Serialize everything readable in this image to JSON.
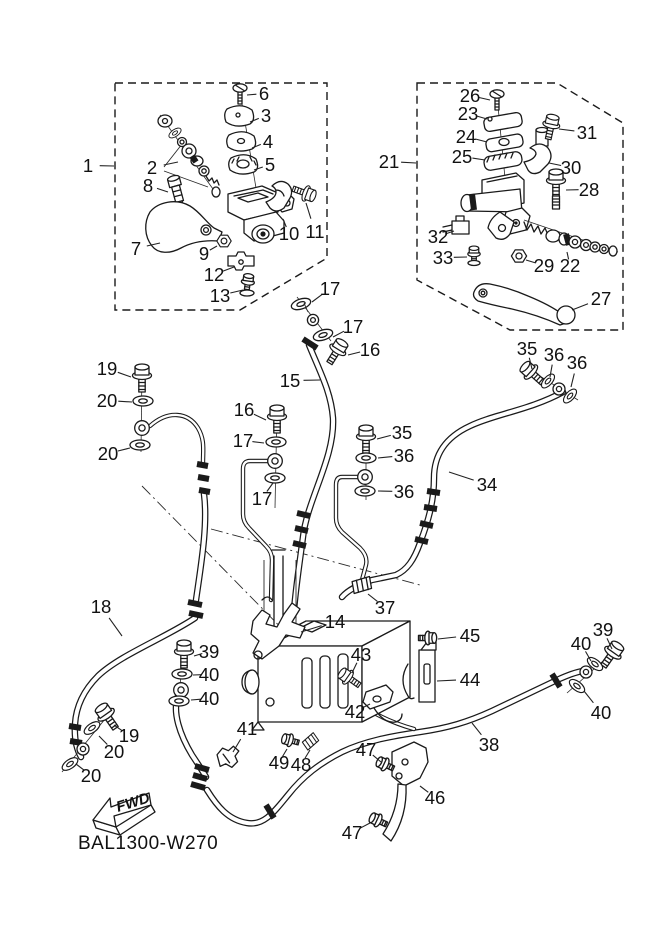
{
  "diagram": {
    "code": "BAL1300-W270",
    "fwd_label": "FWD"
  },
  "colors": {
    "line": "#1a1a1a",
    "background": "#ffffff"
  },
  "callouts": [
    {
      "n": "1",
      "x": 88,
      "y": 172,
      "lx": 114,
      "ly": 166
    },
    {
      "n": "2",
      "x": 152,
      "y": 174,
      "lx": 178,
      "ly": 162
    },
    {
      "n": "6",
      "x": 264,
      "y": 100,
      "lx": 247,
      "ly": 95
    },
    {
      "n": "3",
      "x": 266,
      "y": 122,
      "lx": 250,
      "ly": 122
    },
    {
      "n": "4",
      "x": 268,
      "y": 148,
      "lx": 252,
      "ly": 148
    },
    {
      "n": "5",
      "x": 270,
      "y": 171,
      "lx": 254,
      "ly": 170
    },
    {
      "n": "8",
      "x": 148,
      "y": 192,
      "lx": 168,
      "ly": 192
    },
    {
      "n": "7",
      "x": 136,
      "y": 255,
      "lx": 160,
      "ly": 243
    },
    {
      "n": "9",
      "x": 204,
      "y": 260,
      "lx": 217,
      "ly": 246
    },
    {
      "n": "10",
      "x": 289,
      "y": 240,
      "lx": 283,
      "ly": 219
    },
    {
      "n": "11",
      "x": 315,
      "y": 238,
      "lx": 306,
      "ly": 203
    },
    {
      "n": "12",
      "x": 214,
      "y": 281,
      "lx": 234,
      "ly": 267
    },
    {
      "n": "13",
      "x": 220,
      "y": 302,
      "lx": 243,
      "ly": 290
    },
    {
      "n": "17",
      "x": 330,
      "y": 295,
      "lx": 312,
      "ly": 302
    },
    {
      "n": "21",
      "x": 389,
      "y": 168,
      "lx": 416,
      "ly": 163
    },
    {
      "n": "26",
      "x": 470,
      "y": 102,
      "lx": 490,
      "ly": 100
    },
    {
      "n": "23",
      "x": 468,
      "y": 120,
      "lx": 487,
      "ly": 119
    },
    {
      "n": "24",
      "x": 466,
      "y": 143,
      "lx": 487,
      "ly": 142
    },
    {
      "n": "25",
      "x": 462,
      "y": 163,
      "lx": 485,
      "ly": 160
    },
    {
      "n": "31",
      "x": 587,
      "y": 139,
      "lx": 559,
      "ly": 129
    },
    {
      "n": "30",
      "x": 571,
      "y": 174,
      "lx": 549,
      "ly": 163
    },
    {
      "n": "28",
      "x": 589,
      "y": 196,
      "lx": 566,
      "ly": 190
    },
    {
      "n": "32",
      "x": 438,
      "y": 243,
      "lx": 454,
      "ly": 231
    },
    {
      "n": "33",
      "x": 443,
      "y": 264,
      "lx": 467,
      "ly": 257
    },
    {
      "n": "29",
      "x": 544,
      "y": 272,
      "lx": 526,
      "ly": 260
    },
    {
      "n": "22",
      "x": 570,
      "y": 272,
      "lx": 567,
      "ly": 252
    },
    {
      "n": "27",
      "x": 601,
      "y": 305,
      "lx": 572,
      "ly": 310
    },
    {
      "n": "17",
      "x": 353,
      "y": 333,
      "lx": 333,
      "ly": 337
    },
    {
      "n": "16",
      "x": 370,
      "y": 356,
      "lx": 348,
      "ly": 355
    },
    {
      "n": "15",
      "x": 290,
      "y": 387,
      "lx": 320,
      "ly": 380
    },
    {
      "n": "16",
      "x": 244,
      "y": 416,
      "lx": 266,
      "ly": 420
    },
    {
      "n": "17",
      "x": 243,
      "y": 447,
      "lx": 264,
      "ly": 443
    },
    {
      "n": "17",
      "x": 262,
      "y": 505,
      "lx": 273,
      "ly": 483
    },
    {
      "n": "35",
      "x": 402,
      "y": 439,
      "lx": 377,
      "ly": 439
    },
    {
      "n": "36",
      "x": 404,
      "y": 462,
      "lx": 378,
      "ly": 458
    },
    {
      "n": "36",
      "x": 404,
      "y": 498,
      "lx": 378,
      "ly": 491
    },
    {
      "n": "35",
      "x": 527,
      "y": 355,
      "lx": 532,
      "ly": 369
    },
    {
      "n": "36",
      "x": 554,
      "y": 361,
      "lx": 550,
      "ly": 377
    },
    {
      "n": "36",
      "x": 577,
      "y": 369,
      "lx": 571,
      "ly": 387
    },
    {
      "n": "34",
      "x": 487,
      "y": 491,
      "lx": 449,
      "ly": 472
    },
    {
      "n": "19",
      "x": 107,
      "y": 375,
      "lx": 131,
      "ly": 377
    },
    {
      "n": "20",
      "x": 107,
      "y": 407,
      "lx": 132,
      "ly": 402
    },
    {
      "n": "20",
      "x": 108,
      "y": 460,
      "lx": 130,
      "ly": 448
    },
    {
      "n": "18",
      "x": 101,
      "y": 613,
      "lx": 122,
      "ly": 636
    },
    {
      "n": "39",
      "x": 209,
      "y": 658,
      "lx": 194,
      "ly": 656
    },
    {
      "n": "40",
      "x": 209,
      "y": 681,
      "lx": 193,
      "ly": 675
    },
    {
      "n": "40",
      "x": 209,
      "y": 705,
      "lx": 191,
      "ly": 700
    },
    {
      "n": "19",
      "x": 129,
      "y": 742,
      "lx": 114,
      "ly": 725
    },
    {
      "n": "20",
      "x": 114,
      "y": 758,
      "lx": 99,
      "ly": 736
    },
    {
      "n": "20",
      "x": 91,
      "y": 782,
      "lx": 76,
      "ly": 764
    },
    {
      "n": "37",
      "x": 385,
      "y": 614,
      "lx": 368,
      "ly": 594
    },
    {
      "n": "14",
      "x": 335,
      "y": 628,
      "lx": 301,
      "ly": 632
    },
    {
      "n": "43",
      "x": 361,
      "y": 661,
      "lx": 352,
      "ly": 673
    },
    {
      "n": "42",
      "x": 355,
      "y": 718,
      "lx": 370,
      "ly": 704
    },
    {
      "n": "45",
      "x": 470,
      "y": 642,
      "lx": 438,
      "ly": 639
    },
    {
      "n": "44",
      "x": 470,
      "y": 686,
      "lx": 437,
      "ly": 681
    },
    {
      "n": "41",
      "x": 247,
      "y": 735,
      "lx": 233,
      "ly": 752
    },
    {
      "n": "49",
      "x": 279,
      "y": 769,
      "lx": 287,
      "ly": 749
    },
    {
      "n": "48",
      "x": 301,
      "y": 771,
      "lx": 310,
      "ly": 750
    },
    {
      "n": "47",
      "x": 366,
      "y": 756,
      "lx": 381,
      "ly": 762
    },
    {
      "n": "46",
      "x": 435,
      "y": 804,
      "lx": 420,
      "ly": 786
    },
    {
      "n": "47",
      "x": 352,
      "y": 839,
      "lx": 370,
      "ly": 823
    },
    {
      "n": "38",
      "x": 489,
      "y": 751,
      "lx": 472,
      "ly": 723
    },
    {
      "n": "39",
      "x": 603,
      "y": 636,
      "lx": 612,
      "ly": 649
    },
    {
      "n": "40",
      "x": 581,
      "y": 650,
      "lx": 591,
      "ly": 661
    },
    {
      "n": "40",
      "x": 601,
      "y": 719,
      "lx": 584,
      "ly": 691
    }
  ]
}
